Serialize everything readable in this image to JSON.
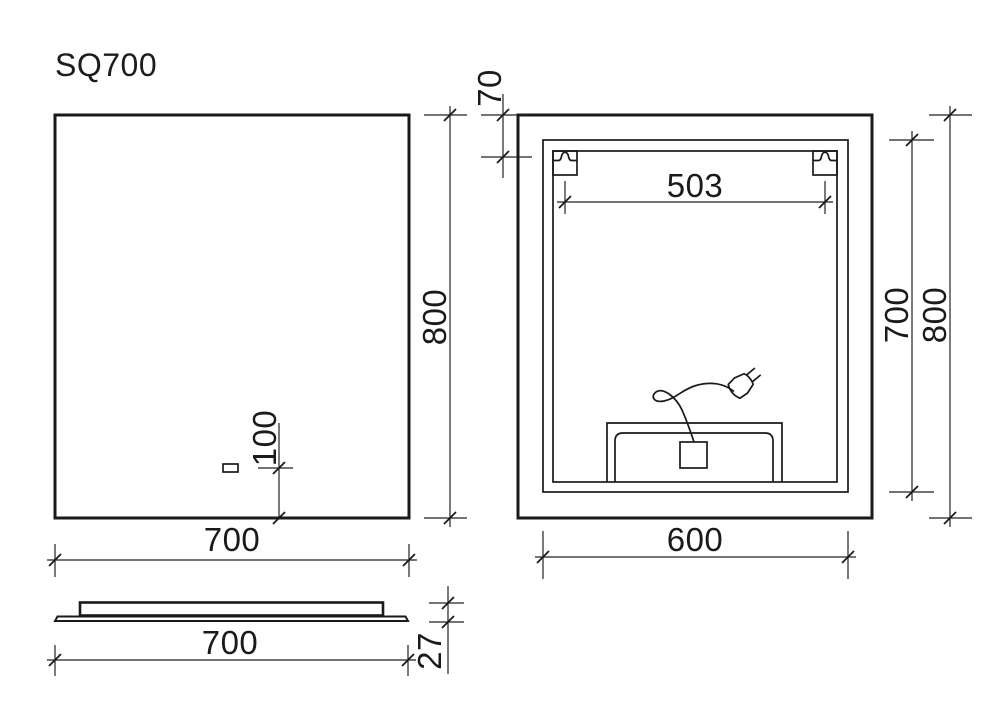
{
  "title": "SQ700",
  "colors": {
    "line": "#1a1a1a",
    "background": "#ffffff"
  },
  "front_view": {
    "width": "700",
    "height": "800",
    "sensor_offset_bottom": "100"
  },
  "back_view": {
    "panel_width": "600",
    "panel_height": "700",
    "overall_height": "800",
    "bracket_spacing": "503",
    "bracket_offset_top": "70"
  },
  "side_view": {
    "width": "700",
    "thickness": "27"
  }
}
